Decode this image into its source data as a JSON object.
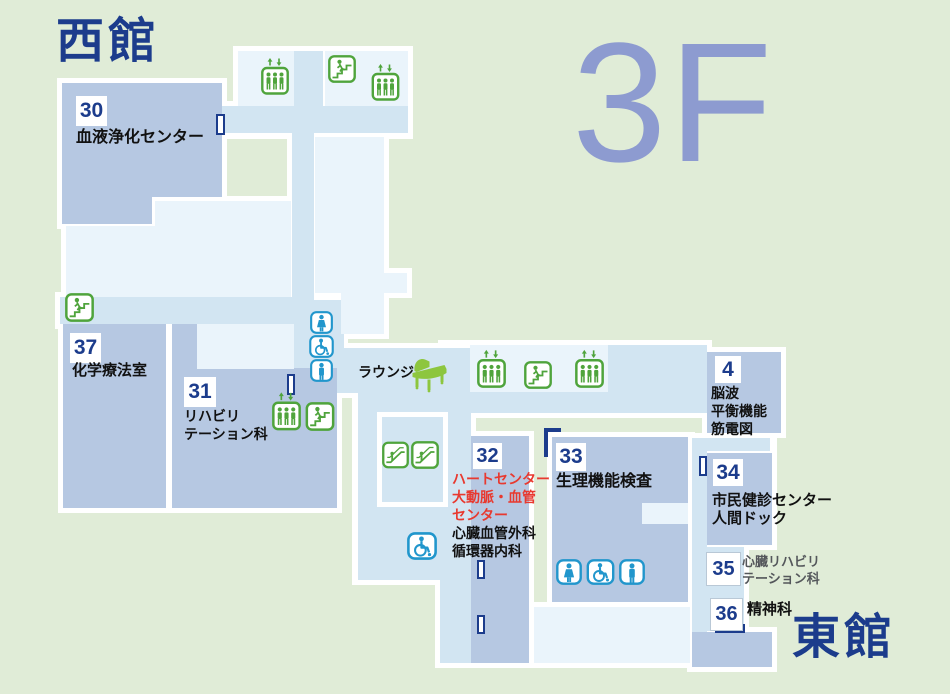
{
  "building_labels": {
    "west": "西館",
    "east": "東館",
    "floor": "3F"
  },
  "lounge": {
    "label": "ラウンジ"
  },
  "rooms": {
    "r30": {
      "num": "30",
      "name": "血液浄化センター"
    },
    "r37": {
      "num": "37",
      "name": "化学療法室"
    },
    "r31": {
      "num": "31",
      "l1": "リハビリ",
      "l2": "テーション科"
    },
    "r32": {
      "num": "32",
      "red1": "ハートセンター",
      "red2": "大動脈・血管",
      "red3": "センター",
      "b1": "心臓血管外科",
      "b2": "循環器内科"
    },
    "r33": {
      "num": "33",
      "name": "生理機能検査"
    },
    "r4": {
      "num": "4",
      "l1": "脳波",
      "l2": "平衡機能",
      "l3": "筋電図"
    },
    "r34": {
      "num": "34",
      "l1": "市民健診センター",
      "l2": "人間ドック"
    },
    "r35": {
      "num": "35",
      "l1": "心臓リハビリ",
      "l2": "テーション科"
    },
    "r36": {
      "num": "36",
      "name": "精神科"
    }
  },
  "icons": {
    "elevator": "elevator-icon",
    "stairs": "stairs-icon",
    "escalator": "escalator-icon",
    "toilet_female": "female-toilet-icon",
    "toilet_male": "male-toilet-icon",
    "accessible_toilet": "accessible-toilet-icon",
    "piano": "grand-piano-icon",
    "door": "door-marker"
  },
  "colors": {
    "background": "#e0ecd7",
    "room_block": "#b6c8e2",
    "corridor": "#d2e5f2",
    "room_pale": "#eaf4fb",
    "outline": "#ffffff",
    "navy": "#1c3c8c",
    "red": "#e8392f",
    "icon_green": "#4fa43c",
    "icon_blue": "#2196cc",
    "piano_green": "#8dc63f",
    "floor_label": "#8d9bd0"
  }
}
